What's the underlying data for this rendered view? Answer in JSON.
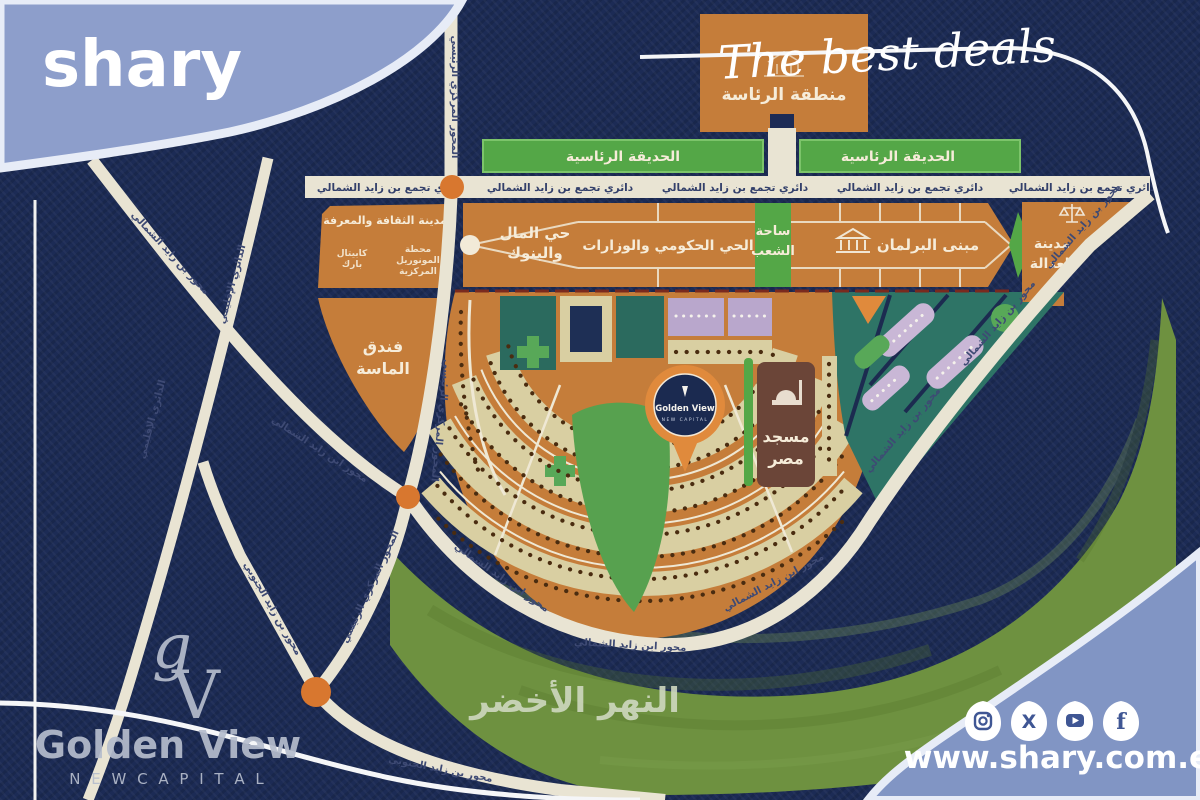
{
  "brand": {
    "logo_text": "shary",
    "tagline": "The best deals",
    "website": "www.shary.com.eg"
  },
  "social": {
    "icons": [
      "instagram",
      "x",
      "youtube",
      "facebook"
    ]
  },
  "watermark": {
    "monogram_g": "g",
    "monogram_v": "V",
    "name": "Golden View",
    "subtitle": "N E W   C A P I T A L"
  },
  "pin": {
    "name": "Golden View",
    "subtitle": "NEW CAPITAL"
  },
  "map": {
    "presidential_zone": "منطقة الرئاسة",
    "presidential_garden": "الحديقة الرئاسية",
    "ring_road": "دائري تجمع بن زايد الشمالي",
    "money_banks_l1": "حي المال",
    "money_banks_l2": "والبنوك",
    "government_district": "الحي الحكومي والوزارات",
    "peoples_square_l1": "ساحة",
    "peoples_square_l2": "الشعب",
    "parliament": "مبنى البرلمان",
    "justice_city_l1": "مدينة",
    "justice_city_l2": "العدالة",
    "culture_city": "مدينة الثقافة والمعرفة",
    "capital_park_l1": "كابيتال",
    "capital_park_l2": "بارك",
    "monorail_l1": "محطة",
    "monorail_l2": "المونوريل",
    "monorail_l3": "المركزية",
    "almasa_l1": "فندق",
    "almasa_l2": "الماسة",
    "mosque_l1": "مسجد",
    "mosque_l2": "مصر",
    "green_river": "النهر الأخضر",
    "axis_north": "محور بن زايد الشمالي",
    "axis_north_alt": "محور ابن زايد الشمالي",
    "axis_south": "محور بن زايد الجنوبي",
    "regional_ring": "الدائري الإقليمي",
    "central_axis": "المحور المركزي الرئيسي"
  },
  "colors": {
    "navy": "#1c2b55",
    "block_orange": "#c57d3a",
    "garden_green": "#54a747",
    "river_green": "#6e9140",
    "wave_blue": "#8d9ecb",
    "pin_orange": "#e08a3c",
    "road_white": "#e9e4d3"
  }
}
